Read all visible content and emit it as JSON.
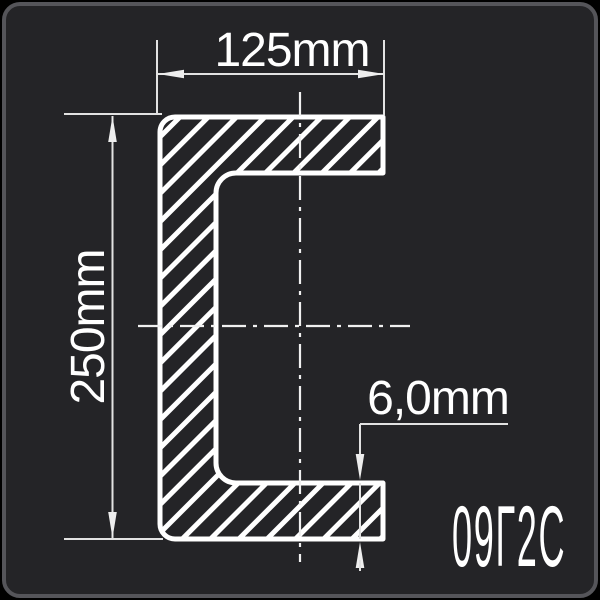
{
  "drawing": {
    "width_label": "125mm",
    "height_label": "250mm",
    "thickness_label": "6,0mm",
    "steel_grade": "09Г2С"
  },
  "colors": {
    "canvas_background": "#000000",
    "panel_background": "#242427",
    "panel_border": "#55555a",
    "profile_line": "#ffffff",
    "dimension_line": "#e2e2e2",
    "text": "#ffffff"
  }
}
